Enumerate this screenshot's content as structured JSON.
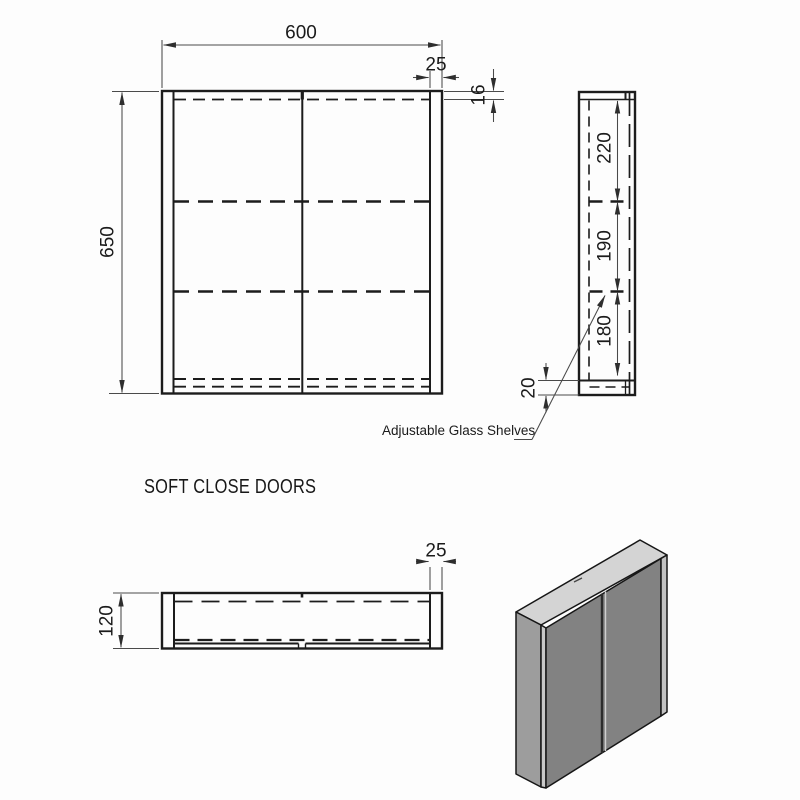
{
  "views": {
    "front": {
      "width": "600",
      "side_panel_width": "25",
      "top_panel_thickness": "16",
      "height": "650"
    },
    "side": {
      "shelf_gap_top": "220",
      "shelf_gap_middle": "190",
      "shelf_gap_bottom": "180",
      "bottom_offset": "20"
    },
    "plan": {
      "panel_width": "25",
      "depth": "120"
    }
  },
  "annotations": {
    "shelves_note": "Adjustable Glass Shelves",
    "caption": "SOFT CLOSE DOORS"
  },
  "colors": {
    "line": "#1c1c1c",
    "dimension": "#3f3f3f",
    "iso_top": "#d4d4d4",
    "iso_left": "#9d9d9d",
    "iso_front_edge": "#c9c9c9",
    "iso_doors": "#828282",
    "iso_right_edge": "#c2c2c2"
  }
}
